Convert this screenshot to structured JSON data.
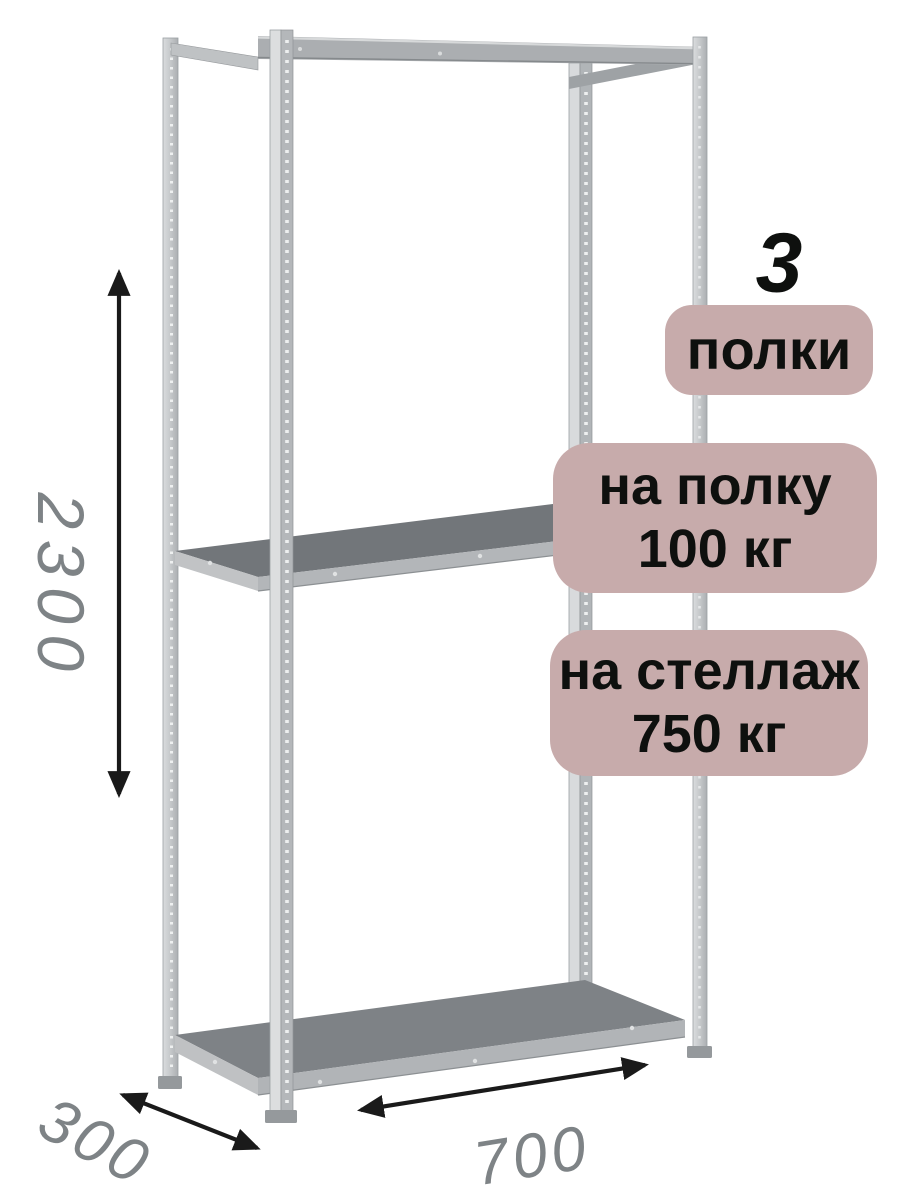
{
  "badges": {
    "count_value": "3",
    "count_label": "полки",
    "per_shelf_line1": "на полку",
    "per_shelf_line2": "100 кг",
    "per_rack_line1": "на стеллаж",
    "per_rack_line2": "750 кг"
  },
  "dimensions": {
    "height_mm": "2300",
    "depth_mm": "300",
    "width_mm": "700"
  },
  "rack": {
    "shelf_count": 3,
    "description": "metal-boltless-shelving-unit-3-shelves"
  },
  "colors": {
    "badge_bg": "#c7abab",
    "badge_text": "#0e100e",
    "dimension_text": "#7e8386",
    "arrow_color": "#1a1a1a",
    "canvas_bg": "#ffffff",
    "metal_light": "#d8dadc",
    "metal_mid": "#b3b6b9",
    "metal_dark": "#75797d"
  }
}
